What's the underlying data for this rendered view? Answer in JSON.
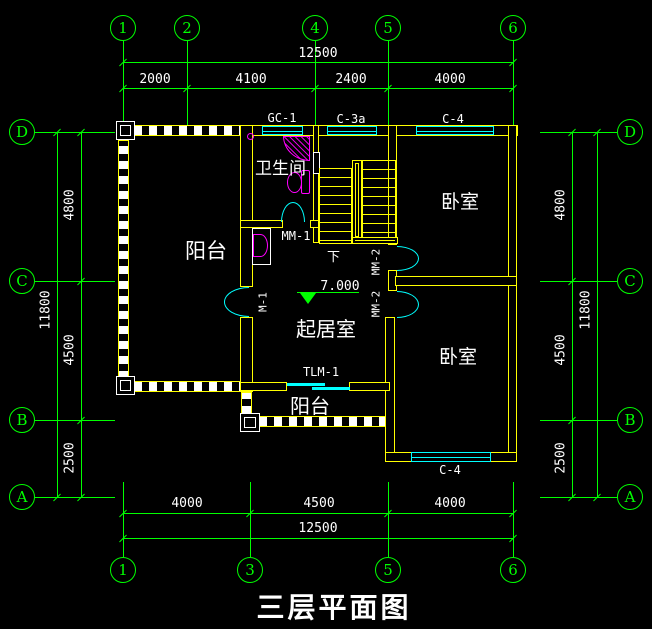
{
  "title": "三层平面图",
  "colors": {
    "background": "#000000",
    "axis_green": "#00ff00",
    "wall_yellow": "#ffff00",
    "opening_cyan": "#00ffff",
    "fixture_magenta": "#ff00ff",
    "text_white": "#ffffff"
  },
  "axes": {
    "top": [
      "1",
      "2",
      "4",
      "5",
      "6"
    ],
    "bottom": [
      "1",
      "3",
      "5",
      "6"
    ],
    "left": [
      "D",
      "C",
      "B",
      "A"
    ],
    "right": [
      "D",
      "C",
      "B",
      "A"
    ]
  },
  "dims": {
    "top_total": "12500",
    "top_segs": [
      "2000",
      "4100",
      "2400",
      "4000"
    ],
    "bottom_segs": [
      "4000",
      "4500",
      "4000"
    ],
    "bottom_total": "12500",
    "left_segs": [
      "4800",
      "4500",
      "2500"
    ],
    "left_total": "11800",
    "right_segs": [
      "4800",
      "4500",
      "2500"
    ],
    "right_total": "11800"
  },
  "rooms": {
    "bathroom": "卫生间",
    "bedroom_top": "卧室",
    "bedroom_bottom": "卧室",
    "living": "起居室",
    "balcony_left": "阳台",
    "balcony_bottom": "阳台"
  },
  "tags": {
    "gc1": "GC-1",
    "c3a": "C-3a",
    "c4_top": "C-4",
    "c4_bottom": "C-4",
    "mm1": "MM-1",
    "m1": "M-1",
    "mm2_a": "MM-2",
    "mm2_b": "MM-2",
    "tlm1": "TLM-1",
    "stair_down": "下",
    "level": "7.000"
  }
}
